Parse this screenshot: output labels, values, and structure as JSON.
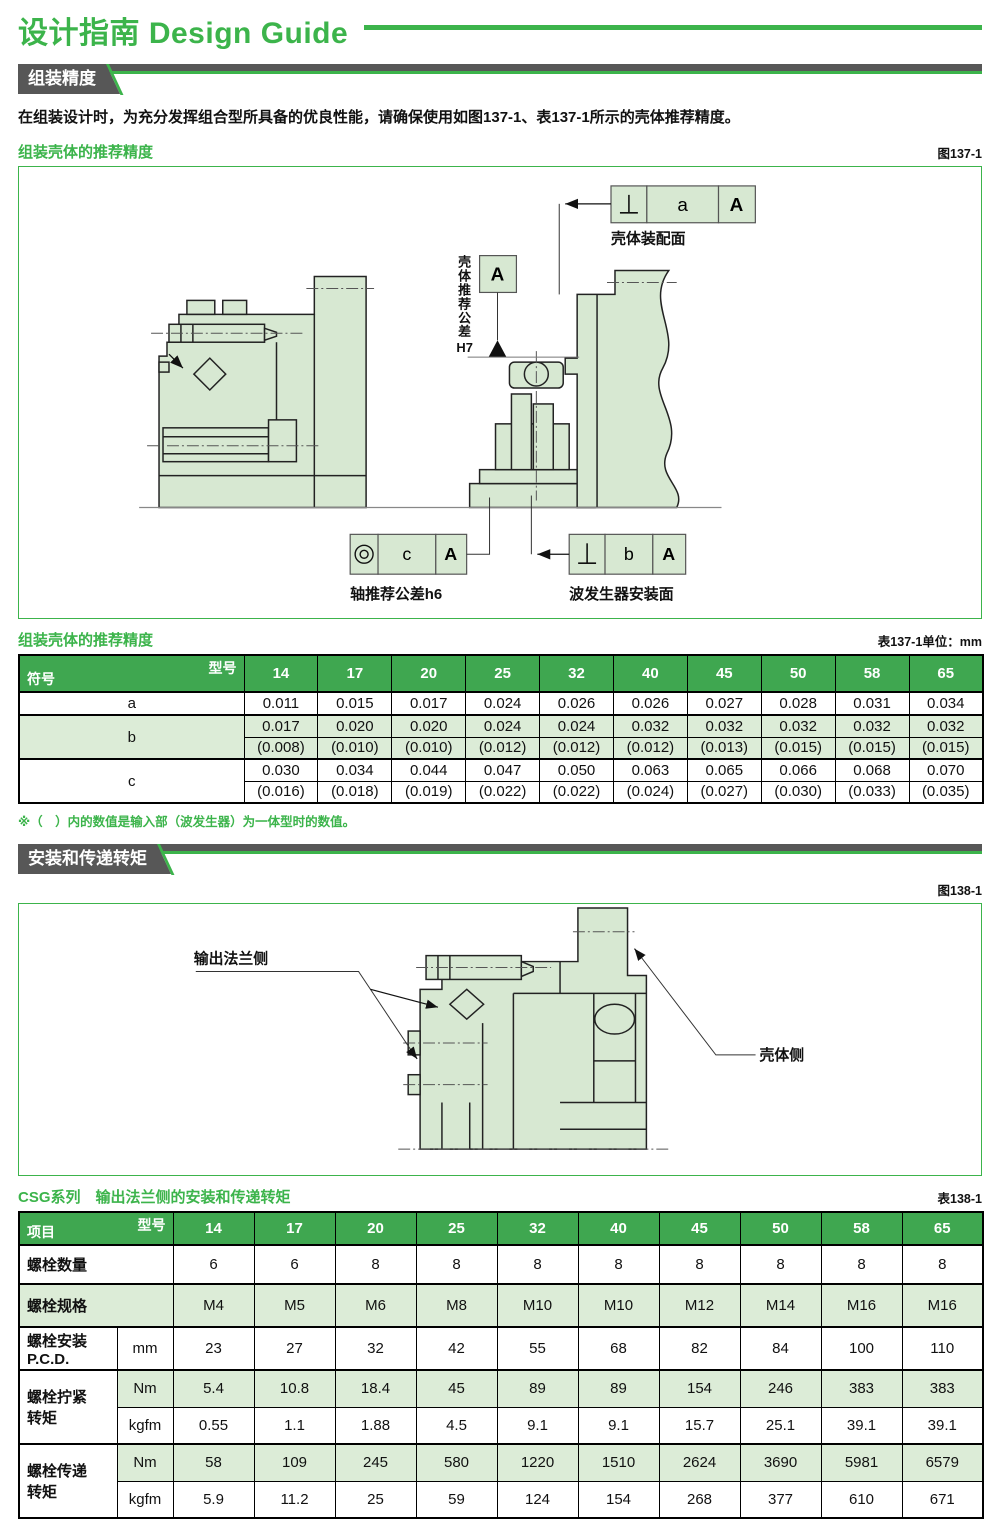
{
  "page": {
    "title": "设计指南 Design Guide",
    "fig137_label": "图137-1",
    "tbl137_label": "表137-1单位：mm",
    "fig138_label": "图138-1",
    "tbl138_label": "表138-1"
  },
  "colors": {
    "accent_green": "#3cb44b",
    "table_header_green": "#3fa750",
    "row_tint_green": "#dcecd7",
    "banner_gray": "#575757",
    "diagram_fill_green": "#d7e8d2"
  },
  "section_assembly": {
    "banner": "组装精度",
    "intro": "在组装设计时，为充分发挥组合型所具备的优良性能，请确保使用如图137-1、表137-1所示的壳体推荐精度。",
    "figure_title": "组装壳体的推荐精度",
    "table_title": "组装壳体的推荐精度",
    "note": "※（　）内的数值是输入部（波发生器）为一体型时的数值。"
  },
  "figure137": {
    "callout_top": {
      "tolerance": "a",
      "datum": "A",
      "label": "壳体装配面"
    },
    "callout_axis": {
      "tolerance": "c",
      "datum": "A",
      "label": "轴推荐公差h6"
    },
    "callout_wg": {
      "tolerance": "b",
      "datum": "A",
      "label": "波发生器安装面"
    },
    "datum_letter": "A",
    "housing_tol_vertical": "壳体推荐公差",
    "housing_tol_suffix": "H7"
  },
  "table137": {
    "corner_top": "型号",
    "corner_bottom": "符号",
    "models": [
      "14",
      "17",
      "20",
      "25",
      "32",
      "40",
      "45",
      "50",
      "58",
      "65"
    ],
    "rows": [
      {
        "symbol": "a",
        "tint": false,
        "lines": [
          [
            "0.011",
            "0.015",
            "0.017",
            "0.024",
            "0.026",
            "0.026",
            "0.027",
            "0.028",
            "0.031",
            "0.034"
          ]
        ]
      },
      {
        "symbol": "b",
        "tint": true,
        "lines": [
          [
            "0.017",
            "0.020",
            "0.020",
            "0.024",
            "0.024",
            "0.032",
            "0.032",
            "0.032",
            "0.032",
            "0.032"
          ],
          [
            "(0.008)",
            "(0.010)",
            "(0.010)",
            "(0.012)",
            "(0.012)",
            "(0.012)",
            "(0.013)",
            "(0.015)",
            "(0.015)",
            "(0.015)"
          ]
        ]
      },
      {
        "symbol": "c",
        "tint": false,
        "lines": [
          [
            "0.030",
            "0.034",
            "0.044",
            "0.047",
            "0.050",
            "0.063",
            "0.065",
            "0.066",
            "0.068",
            "0.070"
          ],
          [
            "(0.016)",
            "(0.018)",
            "(0.019)",
            "(0.022)",
            "(0.022)",
            "(0.024)",
            "(0.027)",
            "(0.030)",
            "(0.033)",
            "(0.035)"
          ]
        ]
      }
    ]
  },
  "section_mounting": {
    "banner": "安装和传递转矩",
    "table_title": "CSG系列　输出法兰侧的安装和传递转矩"
  },
  "figure138": {
    "label_left": "输出法兰侧",
    "label_right": "壳体侧"
  },
  "table138": {
    "corner_top": "型号",
    "corner_bottom": "项目",
    "models": [
      "14",
      "17",
      "20",
      "25",
      "32",
      "40",
      "45",
      "50",
      "58",
      "65"
    ],
    "rows": [
      {
        "label": "螺栓数量",
        "label2": "",
        "unit": null,
        "tint": false,
        "values": [
          "6",
          "6",
          "8",
          "8",
          "8",
          "8",
          "8",
          "8",
          "8",
          "8"
        ]
      },
      {
        "label": "螺栓规格",
        "label2": "",
        "unit": null,
        "tint": true,
        "values": [
          "M4",
          "M5",
          "M6",
          "M8",
          "M10",
          "M10",
          "M12",
          "M14",
          "M16",
          "M16"
        ]
      },
      {
        "label": "螺栓安装",
        "label2": "P.C.D.",
        "unit": "mm",
        "tint": false,
        "values": [
          "23",
          "27",
          "32",
          "42",
          "55",
          "68",
          "82",
          "84",
          "100",
          "110"
        ]
      },
      {
        "label": "螺栓拧紧",
        "label2": "转矩",
        "subrows": [
          {
            "unit": "Nm",
            "tint": true,
            "values": [
              "5.4",
              "10.8",
              "18.4",
              "45",
              "89",
              "89",
              "154",
              "246",
              "383",
              "383"
            ]
          },
          {
            "unit": "kgfm",
            "tint": false,
            "values": [
              "0.55",
              "1.1",
              "1.88",
              "4.5",
              "9.1",
              "9.1",
              "15.7",
              "25.1",
              "39.1",
              "39.1"
            ]
          }
        ]
      },
      {
        "label": "螺栓传递",
        "label2": "转矩",
        "subrows": [
          {
            "unit": "Nm",
            "tint": true,
            "values": [
              "58",
              "109",
              "245",
              "580",
              "1220",
              "1510",
              "2624",
              "3690",
              "5981",
              "6579"
            ]
          },
          {
            "unit": "kgfm",
            "tint": false,
            "values": [
              "5.9",
              "11.2",
              "25",
              "59",
              "124",
              "154",
              "268",
              "377",
              "610",
              "671"
            ]
          }
        ]
      }
    ]
  }
}
